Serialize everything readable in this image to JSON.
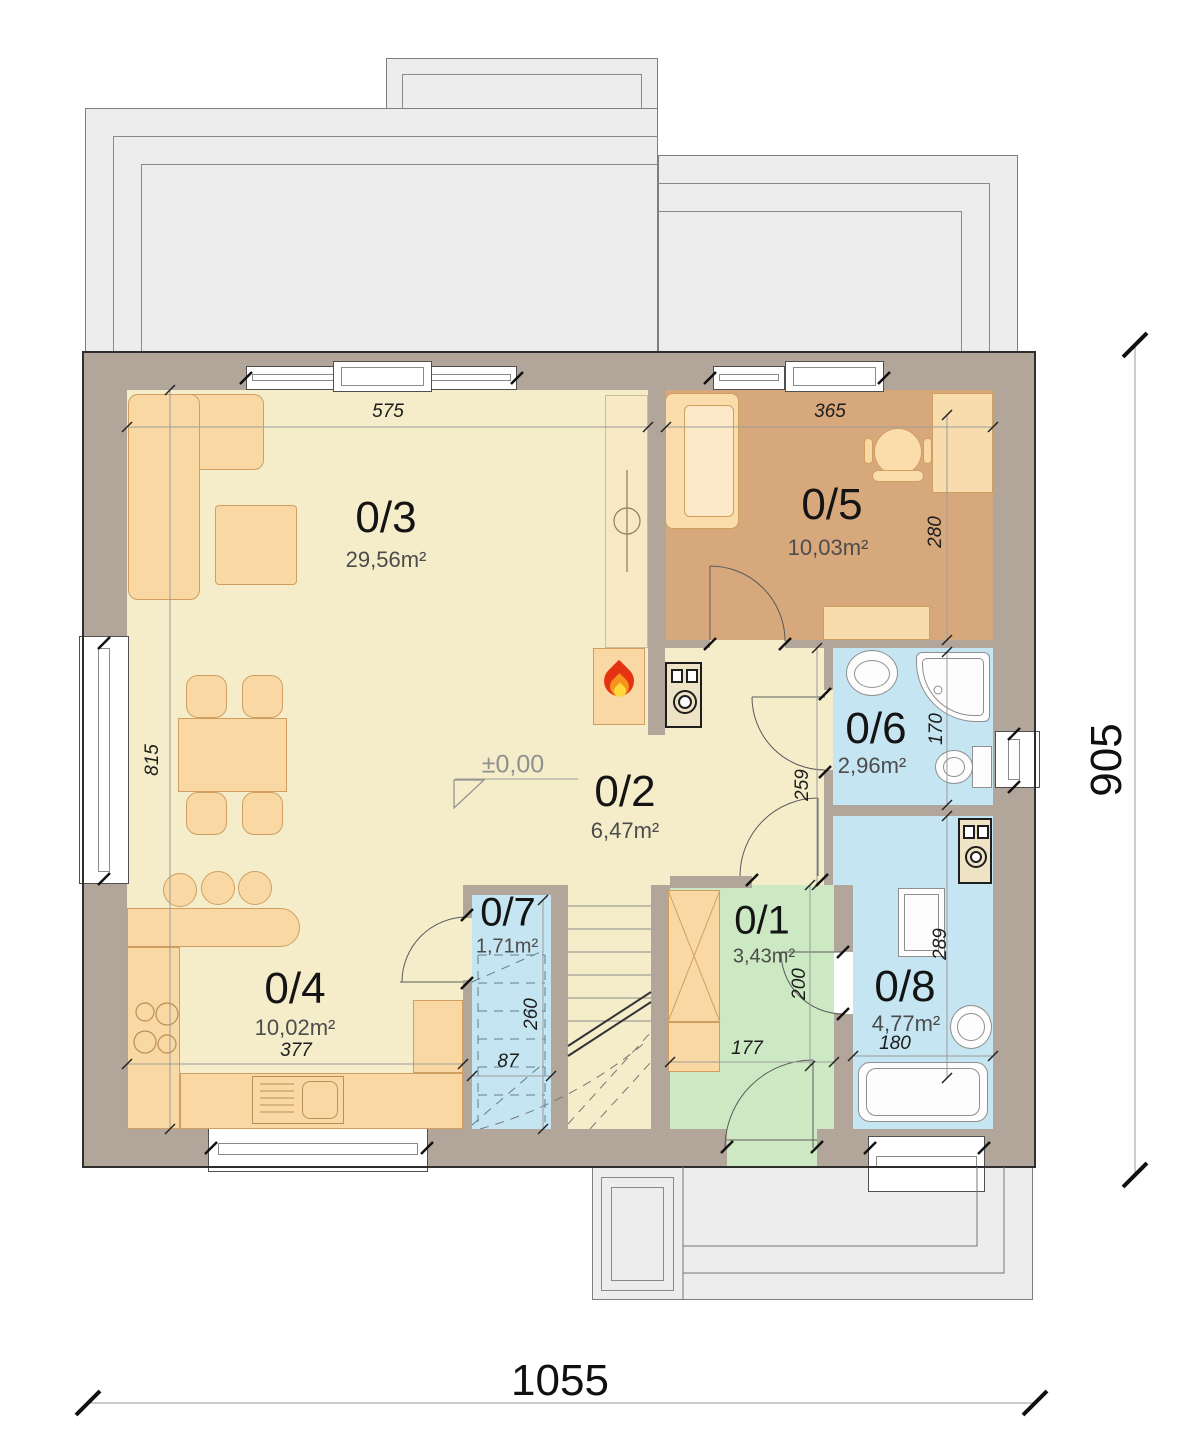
{
  "colors": {
    "wall": "#b2a69b",
    "floor-main": "#f5edca",
    "floor-office": "#d8a87d",
    "floor-bath": "#c4e5f1",
    "floor-entry": "#cde9c4",
    "terrace": "#ededed",
    "furn": "#f9d8a4",
    "furnbr": "#cf9f62",
    "chimney": "#f7e9c4",
    "fred": "#e53212",
    "forange": "#f7941d",
    "fyellow": "#ffd83b"
  },
  "rooms": {
    "r1": {
      "label": "0/1",
      "area": "3,43m²"
    },
    "r2": {
      "label": "0/2",
      "area": "6,47m²"
    },
    "r3": {
      "label": "0/3",
      "area": "29,56m²"
    },
    "r4": {
      "label": "0/4",
      "area": "10,02m²"
    },
    "r5": {
      "label": "0/5",
      "area": "10,03m²"
    },
    "r6": {
      "label": "0/6",
      "area": "2,96m²"
    },
    "r7": {
      "label": "0/7",
      "area": "1,71m²"
    },
    "r8": {
      "label": "0/8",
      "area": "4,77m²"
    }
  },
  "dims": {
    "overall_width": "1055",
    "overall_height": "905",
    "living_top": "575",
    "living_left": "815",
    "office_top": "365",
    "office_right": "280",
    "wc_height": "170",
    "hall_height": "259",
    "kitchen_width": "377",
    "closet_height": "260",
    "closet_width": "87",
    "entry_width": "177",
    "entry_height": "200",
    "bath_height": "289",
    "bath_width": "180"
  },
  "level_marker": "±0,00"
}
